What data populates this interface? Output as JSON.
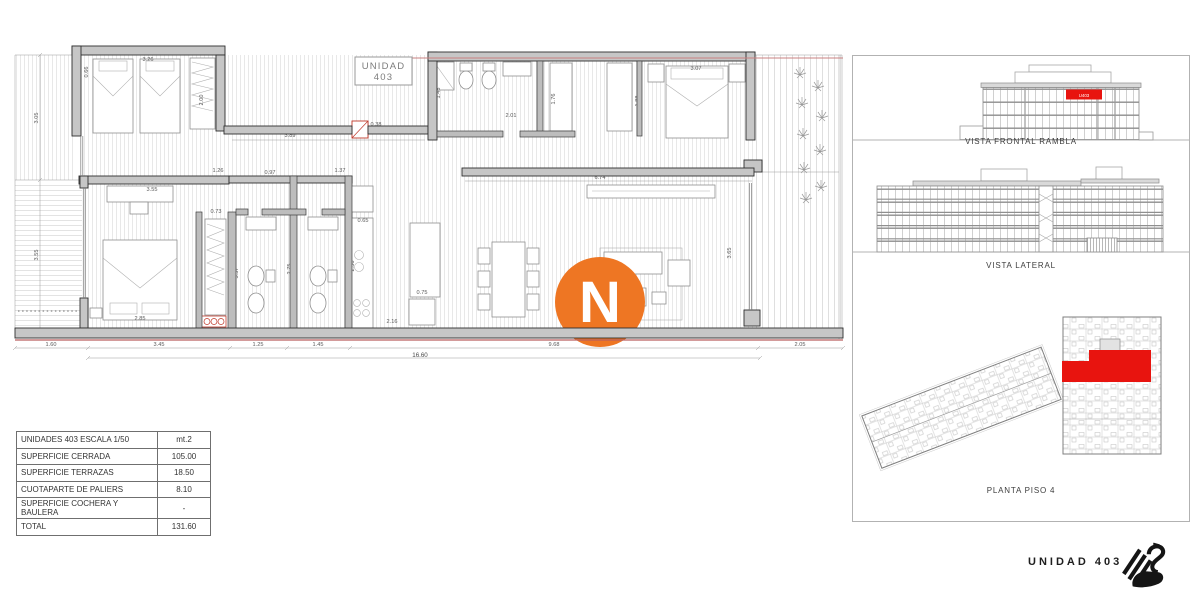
{
  "plan": {
    "unit_box": {
      "line1": "UNIDAD",
      "line2": "403"
    },
    "logo_letter": "N",
    "colors": {
      "accent_orange": "#EE7623",
      "highlight_red": "#E8140F",
      "boundary_red": "#C98080"
    },
    "dimensions": {
      "left": [
        "3.05",
        "3.55"
      ],
      "bottom": [
        "1.60",
        "3.45",
        "1.25",
        "1.45",
        "9.68",
        "2.05"
      ],
      "bottom_total": "16.60",
      "interior": [
        "0.66",
        "3.26",
        "2.00",
        "3.89",
        "1.26",
        "0.97",
        "1.37",
        "3.55",
        "0.73",
        "2.85",
        "0.75",
        "2.16",
        "2.36",
        "3.57",
        "2.75",
        "6.74",
        "1.76",
        "1.88",
        "3.07",
        "1.43",
        "2.01",
        "3.65",
        "0.45",
        "0.65",
        "0.38"
      ]
    }
  },
  "table": {
    "rows": [
      {
        "label": "UNIDADES 403  ESCALA 1/50",
        "value": "mt.2"
      },
      {
        "label": "SUPERFICIE  CERRADA",
        "value": "105.00"
      },
      {
        "label": "SUPERFICIE  TERRAZAS",
        "value": "18.50"
      },
      {
        "label": "CUOTAPARTE DE PALIERS",
        "value": "8.10"
      },
      {
        "label": "SUPERFICIE COCHERA Y BAULERA",
        "value": "-"
      },
      {
        "label": "TOTAL",
        "value": "131.60"
      }
    ]
  },
  "panel": {
    "views": [
      {
        "label": "VISTA FRONTAL RAMBLA",
        "highlight_tag": "U403"
      },
      {
        "label": "VISTA LATERAL"
      },
      {
        "label": "PLANTA PISO 4"
      }
    ]
  },
  "footer": {
    "brand": "UNIDAD 403"
  }
}
